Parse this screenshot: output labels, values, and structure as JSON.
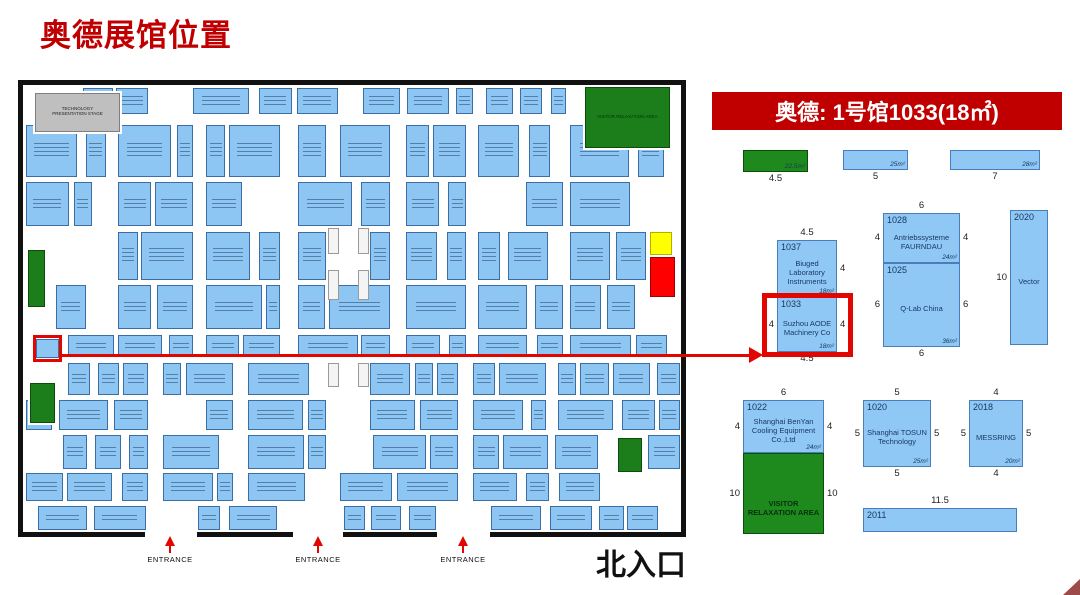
{
  "title": "奥德展馆位置",
  "colors": {
    "accent_red": "#c00000",
    "pointer_red": "#e10600",
    "booth_blue": "#8fc8f5",
    "booth_border": "#4a7ebb",
    "green_area": "#1e8a1e",
    "marker_yellow": "#ffff00",
    "marker_red": "#ff0000",
    "stage_gray": "#bfbfbf"
  },
  "map": {
    "seed": 11,
    "north_label": "北入口",
    "entrance_label": "ENTRANCE",
    "entrances_x": [
      170,
      318,
      463
    ],
    "bottom_border_segments": [
      [
        0,
        127
      ],
      [
        179,
        275
      ],
      [
        325,
        419
      ],
      [
        472,
        668
      ]
    ],
    "landmarks": [
      {
        "name": "technology-presentation-stage",
        "x": 17,
        "y": 13,
        "w": 85,
        "h": 39,
        "fill": "#bfbfbf",
        "border": "#7f7f7f",
        "label": "TECHNOLOGY PRESENTATION STAGE",
        "labelColor": "#222222"
      },
      {
        "name": "visitor-relaxation-area-map",
        "x": 567,
        "y": 7,
        "w": 85,
        "h": 61,
        "fill": "#1b7e1b",
        "border": "#0b4d0b",
        "label": "VISITOR RELAXATION AREA",
        "labelColor": "#05300a"
      },
      {
        "name": "yellow-marker",
        "x": 632,
        "y": 152,
        "w": 22,
        "h": 23,
        "fill": "#ffff00",
        "border": "#b0b000",
        "label": ""
      },
      {
        "name": "red-marker",
        "x": 632,
        "y": 177,
        "w": 25,
        "h": 40,
        "fill": "#ff0000",
        "border": "#a00000",
        "label": ""
      },
      {
        "name": "green-area-left-upper",
        "x": 10,
        "y": 170,
        "w": 17,
        "h": 57,
        "fill": "#1b7e1b",
        "border": "#0b4d0b",
        "label": ""
      },
      {
        "name": "green-area-left-lower",
        "x": 12,
        "y": 303,
        "w": 25,
        "h": 40,
        "fill": "#1b7e1b",
        "border": "#0b4d0b",
        "label": ""
      },
      {
        "name": "green-area-bottom-mid",
        "x": 600,
        "y": 358,
        "w": 24,
        "h": 34,
        "fill": "#1b7e1b",
        "border": "#0b4d0b",
        "label": ""
      },
      {
        "name": "aode-booth-on-map",
        "x": 18,
        "y": 259,
        "w": 23,
        "h": 19,
        "fill": "#8dc6f2",
        "border": "#3a6ea5",
        "label": ""
      }
    ],
    "pillars": [
      [
        310,
        148,
        11,
        26
      ],
      [
        340,
        148,
        11,
        26
      ],
      [
        310,
        190,
        11,
        30
      ],
      [
        340,
        190,
        11,
        30
      ],
      [
        310,
        283,
        11,
        24
      ],
      [
        340,
        283,
        11,
        24
      ]
    ],
    "bands": [
      {
        "y": 8,
        "h": 26,
        "segs": [
          [
            65,
            130
          ],
          [
            175,
            320
          ],
          [
            345,
            455
          ],
          [
            468,
            548
          ]
        ]
      },
      {
        "y": 45,
        "h": 52,
        "segs": [
          [
            8,
            88
          ],
          [
            100,
            175
          ],
          [
            188,
            262
          ],
          [
            280,
            308
          ],
          [
            322,
            372
          ],
          [
            388,
            448
          ],
          [
            460,
            545
          ],
          [
            552,
            662
          ]
        ]
      },
      {
        "y": 102,
        "h": 44,
        "segs": [
          [
            8,
            88
          ],
          [
            100,
            175
          ],
          [
            188,
            262
          ],
          [
            280,
            372
          ],
          [
            388,
            448
          ],
          [
            460,
            545
          ],
          [
            552,
            628
          ]
        ]
      },
      {
        "y": 152,
        "h": 48,
        "segs": [
          [
            38,
            88
          ],
          [
            100,
            175
          ],
          [
            188,
            262
          ],
          [
            280,
            308
          ],
          [
            352,
            372
          ],
          [
            388,
            448
          ],
          [
            460,
            545
          ],
          [
            552,
            628
          ]
        ]
      },
      {
        "y": 205,
        "h": 44,
        "segs": [
          [
            38,
            88
          ],
          [
            100,
            175
          ],
          [
            188,
            262
          ],
          [
            280,
            372
          ],
          [
            388,
            448
          ],
          [
            460,
            545
          ],
          [
            552,
            628
          ]
        ]
      },
      {
        "y": 255,
        "h": 22,
        "segs": [
          [
            50,
            175
          ],
          [
            188,
            262
          ],
          [
            280,
            372
          ],
          [
            388,
            448
          ],
          [
            460,
            545
          ],
          [
            552,
            662
          ]
        ]
      },
      {
        "y": 283,
        "h": 32,
        "segs": [
          [
            50,
            130
          ],
          [
            145,
            215
          ],
          [
            230,
            308
          ],
          [
            352,
            440
          ],
          [
            455,
            528
          ],
          [
            540,
            662
          ]
        ]
      },
      {
        "y": 320,
        "h": 30,
        "segs": [
          [
            8,
            130
          ],
          [
            145,
            215
          ],
          [
            230,
            308
          ],
          [
            352,
            440
          ],
          [
            455,
            528
          ],
          [
            540,
            662
          ]
        ]
      },
      {
        "y": 355,
        "h": 34,
        "segs": [
          [
            45,
            130
          ],
          [
            145,
            215
          ],
          [
            230,
            308
          ],
          [
            322,
            440
          ],
          [
            455,
            595
          ],
          [
            630,
            662
          ]
        ]
      },
      {
        "y": 393,
        "h": 28,
        "segs": [
          [
            8,
            130
          ],
          [
            145,
            215
          ],
          [
            230,
            308
          ],
          [
            322,
            440
          ],
          [
            455,
            595
          ],
          [
            605,
            662
          ]
        ]
      },
      {
        "y": 426,
        "h": 24,
        "segs": [
          [
            20,
            128
          ],
          [
            180,
            274
          ],
          [
            326,
            418
          ],
          [
            473,
            640
          ]
        ]
      }
    ]
  },
  "detail": {
    "header": "奥德: 1号馆1033(18㎡)",
    "booths": [
      {
        "id": "green-bar",
        "x": 33,
        "y": 65,
        "w": 65,
        "h": 22,
        "fill": "green",
        "area": "22.5m²",
        "bottom": "4.5"
      },
      {
        "id": "bar-25",
        "x": 133,
        "y": 65,
        "w": 65,
        "h": 20,
        "area": "25m²",
        "bottom": "5"
      },
      {
        "id": "bar-28",
        "x": 240,
        "y": 65,
        "w": 90,
        "h": 20,
        "area": "28m²",
        "bottom": "7"
      },
      {
        "id": "1037",
        "x": 67,
        "y": 155,
        "w": 60,
        "h": 57,
        "number": "1037",
        "name": "Biuged Laboratory Instruments",
        "top": "4.5",
        "right": "4",
        "area": "18m²"
      },
      {
        "id": "1033",
        "x": 67,
        "y": 212,
        "w": 60,
        "h": 55,
        "number": "1033",
        "name": "Suzhou AODE Machinery Co",
        "left": "4",
        "right": "4",
        "area": "18m²",
        "bottom": "4.5"
      },
      {
        "id": "1028",
        "x": 173,
        "y": 128,
        "w": 77,
        "h": 50,
        "number": "1028",
        "name": "Antriebssysteme FAURNDAU",
        "top": "6",
        "left": "4",
        "right": "4",
        "area": "24m²"
      },
      {
        "id": "1025",
        "x": 173,
        "y": 178,
        "w": 77,
        "h": 84,
        "number": "1025",
        "name": "Q-Lab China",
        "left": "6",
        "right": "6",
        "area": "36m²",
        "bottom": "6"
      },
      {
        "id": "2020",
        "x": 300,
        "y": 125,
        "w": 38,
        "h": 135,
        "number": "2020",
        "name": "Vector",
        "left": "10"
      },
      {
        "id": "1022",
        "x": 33,
        "y": 315,
        "w": 81,
        "h": 53,
        "number": "1022",
        "name": "Shanghai BenYan Cooling Equipment Co.,Ltd",
        "top": "6",
        "left": "4",
        "right": "4",
        "area": "24m²"
      },
      {
        "id": "visitor-area",
        "x": 33,
        "y": 368,
        "w": 81,
        "h": 81,
        "fill": "green",
        "name": "VISITOR RELAXATION AREA",
        "left": "10",
        "right": "10"
      },
      {
        "id": "1020",
        "x": 153,
        "y": 315,
        "w": 68,
        "h": 67,
        "number": "1020",
        "name": "Shanghai TOSUN Technology",
        "top": "5",
        "left": "5",
        "right": "5",
        "area": "25m²",
        "bottom": "5"
      },
      {
        "id": "2018",
        "x": 259,
        "y": 315,
        "w": 54,
        "h": 67,
        "number": "2018",
        "name": "MESSRING",
        "top": "4",
        "left": "5",
        "right": "5",
        "area": "20m²",
        "bottom": "4"
      },
      {
        "id": "2011",
        "x": 153,
        "y": 423,
        "w": 154,
        "h": 24,
        "number": "2011",
        "top": "11.5"
      }
    ]
  }
}
